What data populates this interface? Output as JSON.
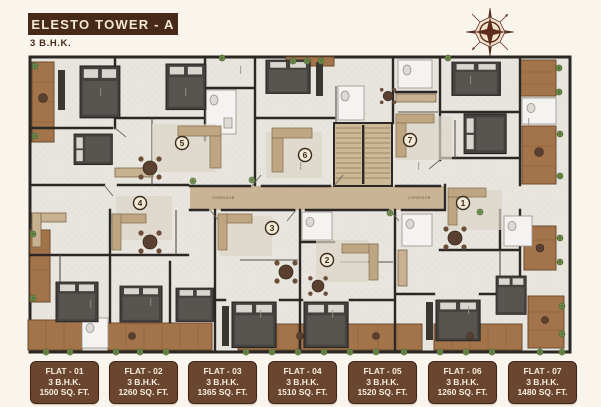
{
  "header": {
    "title": "ELESTO TOWER - A",
    "subtitle": "3 B.H.K."
  },
  "icons": {
    "compass": "compass-rose"
  },
  "plan": {
    "corridor_label": "CORRIDOR",
    "markers": [
      {
        "number": "1"
      },
      {
        "number": "2"
      },
      {
        "number": "3"
      },
      {
        "number": "4"
      },
      {
        "number": "5"
      },
      {
        "number": "6"
      },
      {
        "number": "7"
      }
    ]
  },
  "flats": [
    {
      "name": "FLAT - 01",
      "type": "3 B.H.K.",
      "area": "1500 SQ. FT."
    },
    {
      "name": "FLAT - 02",
      "type": "3 B.H.K.",
      "area": "1260 SQ. FT."
    },
    {
      "name": "FLAT - 03",
      "type": "3 B.H.K.",
      "area": "1365 SQ. FT."
    },
    {
      "name": "FLAT - 04",
      "type": "3 B.H.K.",
      "area": "1510 SQ. FT."
    },
    {
      "name": "FLAT - 05",
      "type": "3 B.H.K.",
      "area": "1520 SQ. FT."
    },
    {
      "name": "FLAT - 06",
      "type": "3 B.H.K.",
      "area": "1260 SQ. FT."
    },
    {
      "name": "FLAT - 07",
      "type": "3 B.H.K.",
      "area": "1480 SQ. FT."
    }
  ],
  "colors": {
    "banner_brown": "#47291a",
    "card_brown": "#6a4530",
    "card_text": "#f6eedd",
    "wall": "#2b2724",
    "floor": "#e8e5df",
    "wood": "#a3744a",
    "corridor_tan": "#c9b596",
    "compass_brown": "#5e2d1f",
    "plant_green": "#6d8a4c"
  }
}
